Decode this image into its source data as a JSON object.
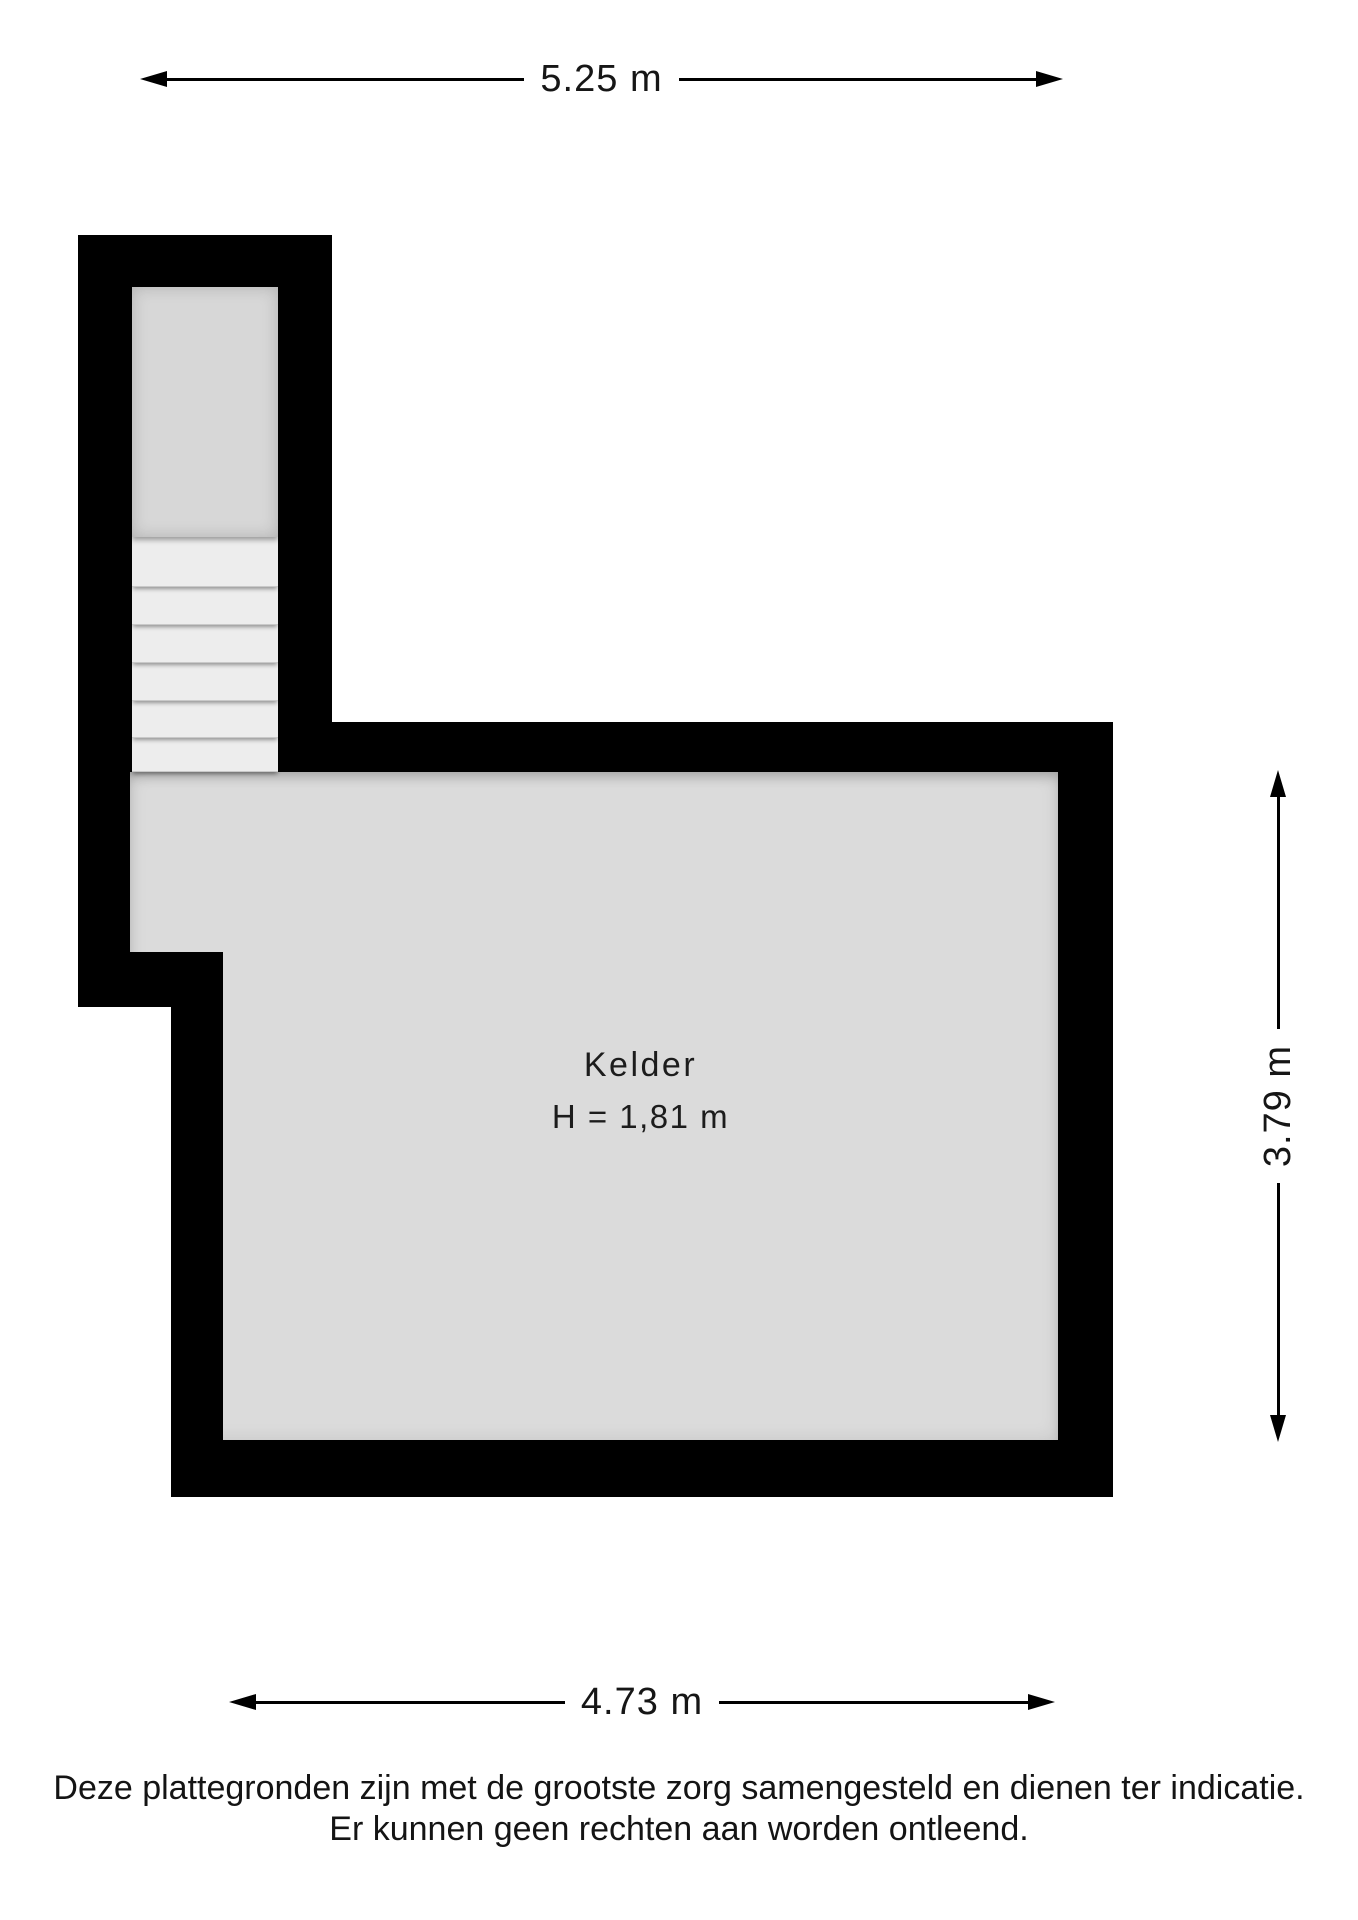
{
  "floorplan": {
    "room": {
      "name": "Kelder",
      "height_label": "H = 1,81 m"
    },
    "dimensions": {
      "top": "5.25 m",
      "bottom": "4.73 m",
      "right": "3.79 m"
    },
    "stairs": {
      "step_count": 6
    },
    "colors": {
      "wall": "#000000",
      "floor": "#dbdbdb",
      "landing": "#d7d7d7",
      "step": "#ededed",
      "page": "#ffffff"
    }
  },
  "disclaimer": {
    "line1": "Deze plattegronden zijn met de grootste zorg samengesteld en dienen ter indicatie.",
    "line2": "Er kunnen geen rechten aan worden ontleend."
  }
}
